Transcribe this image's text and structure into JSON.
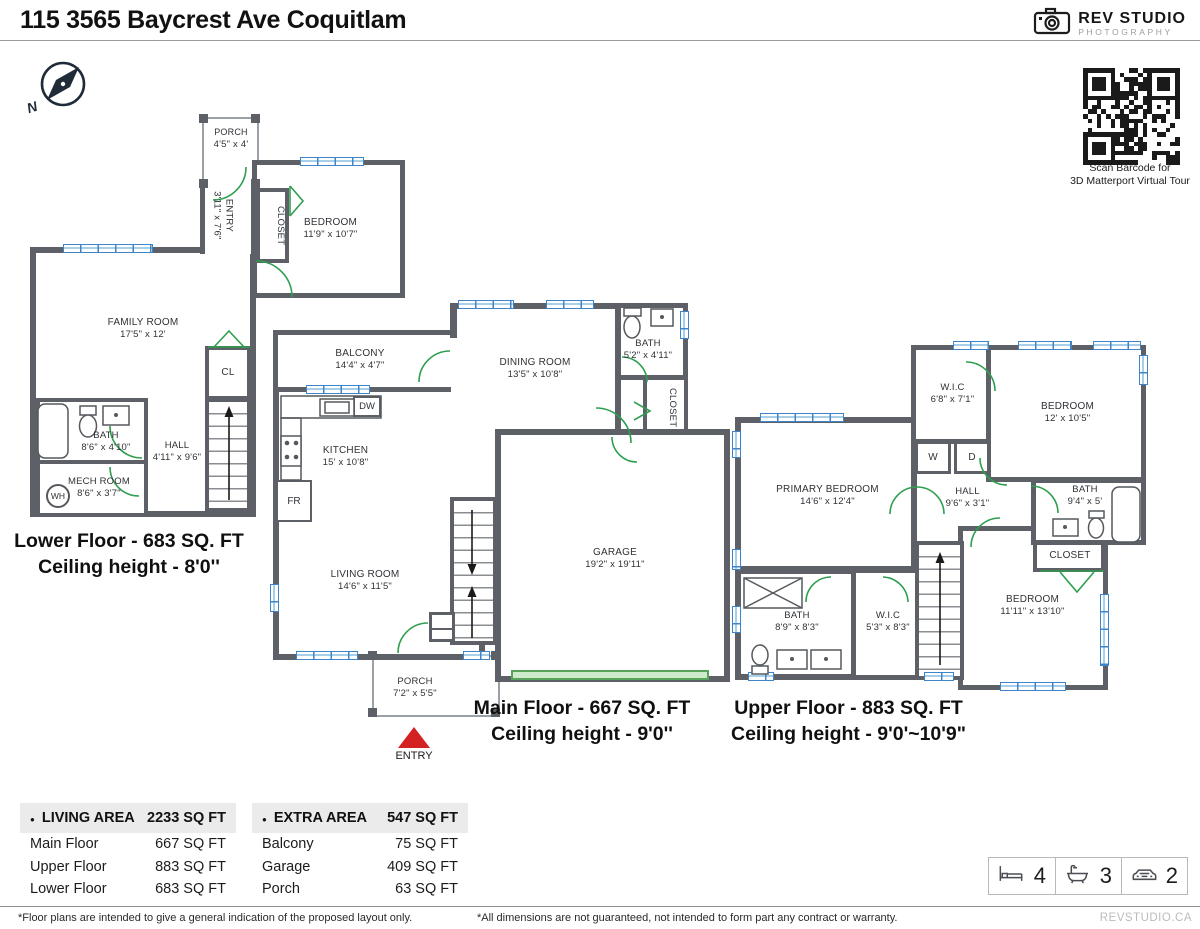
{
  "header": {
    "title": "115 3565 Baycrest Ave Coquitlam",
    "logo": {
      "name": "REV STUDIO",
      "subtitle": "PHOTOGRAPHY"
    }
  },
  "compass": {
    "north": "N"
  },
  "qr": {
    "caption1": "Scan Barcode for",
    "caption2": "3D Matterport Virtual Tour"
  },
  "floors": {
    "lower": {
      "title": "Lower Floor - 683 SQ. FT",
      "ceiling": "Ceiling height - 8'0''",
      "rooms": {
        "porch": {
          "name": "PORCH",
          "dims": "4'5\" x 4'"
        },
        "entry": {
          "name": "ENTRY",
          "dims": "3'11\" x 7'6\""
        },
        "closet": {
          "name": "CLOSET"
        },
        "bedroom": {
          "name": "BEDROOM",
          "dims": "11'9\" x 10'7\""
        },
        "family": {
          "name": "FAMILY ROOM",
          "dims": "17'5\" x 12'"
        },
        "cl": {
          "name": "CL"
        },
        "bath": {
          "name": "BATH",
          "dims": "8'6\" x 4'10\""
        },
        "hall": {
          "name": "HALL",
          "dims": "4'11\" x 9'6\""
        },
        "mech": {
          "name": "MECH ROOM",
          "dims": "8'6\" x 3'7\""
        },
        "wh": {
          "name": "WH"
        }
      }
    },
    "main": {
      "title": "Main Floor - 667 SQ. FT",
      "ceiling": "Ceiling height - 9'0''",
      "entry_label": "ENTRY",
      "rooms": {
        "balcony": {
          "name": "BALCONY",
          "dims": "14'4\" x 4'7\""
        },
        "dining": {
          "name": "DINING ROOM",
          "dims": "13'5\" x 10'8\""
        },
        "bath": {
          "name": "BATH",
          "dims": "5'2\" x 4'11\""
        },
        "closet": {
          "name": "CLOSET"
        },
        "kitchen": {
          "name": "KITCHEN",
          "dims": "15' x 10'8\""
        },
        "dw": {
          "name": "DW"
        },
        "fr": {
          "name": "FR"
        },
        "living": {
          "name": "LIVING ROOM",
          "dims": "14'6\" x 11'5\""
        },
        "garage": {
          "name": "GARAGE",
          "dims": "19'2\" x 19'11\""
        },
        "porch": {
          "name": "PORCH",
          "dims": "7'2\" x 5'5\""
        }
      }
    },
    "upper": {
      "title": "Upper Floor - 883 SQ. FT",
      "ceiling": "Ceiling height - 9'0'~10'9\"",
      "rooms": {
        "primary": {
          "name": "PRIMARY BEDROOM",
          "dims": "14'6\" x 12'4\""
        },
        "wic1": {
          "name": "W.I.C",
          "dims": "6'8\" x 7'1\""
        },
        "bedroom1": {
          "name": "BEDROOM",
          "dims": "12' x 10'5\""
        },
        "washer": {
          "name": "W"
        },
        "dryer": {
          "name": "D"
        },
        "hall": {
          "name": "HALL",
          "dims": "9'6\" x 3'1\""
        },
        "bath1": {
          "name": "BATH",
          "dims": "9'4\" x 5'"
        },
        "closet": {
          "name": "CLOSET"
        },
        "bath2": {
          "name": "BATH",
          "dims": "8'9\" x 8'3\""
        },
        "wic2": {
          "name": "W.I.C",
          "dims": "5'3\" x 8'3\""
        },
        "bedroom2": {
          "name": "BEDROOM",
          "dims": "11'11\" x 13'10\""
        }
      }
    }
  },
  "tables": {
    "bullet": "●",
    "living": {
      "header": "LIVING AREA",
      "total": "2233 SQ FT",
      "rows": [
        {
          "label": "Main Floor",
          "value": "667 SQ FT"
        },
        {
          "label": "Upper Floor",
          "value": "883 SQ FT"
        },
        {
          "label": "Lower Floor",
          "value": "683 SQ FT"
        }
      ]
    },
    "extra": {
      "header": "EXTRA AREA",
      "total": "547 SQ FT",
      "rows": [
        {
          "label": "Balcony",
          "value": "75 SQ FT"
        },
        {
          "label": "Garage",
          "value": "409 SQ FT"
        },
        {
          "label": "Porch",
          "value": "63 SQ FT"
        }
      ]
    }
  },
  "stats": {
    "beds": "4",
    "baths": "3",
    "cars": "2"
  },
  "footer": {
    "note_left": "*Floor plans are intended to give a general indication of the proposed layout only.",
    "note_right": "*All dimensions are not guaranteed, not intended to form part any contract or warranty.",
    "brand": "REVSTUDIO.CA"
  },
  "colors": {
    "wall": "#5d6066",
    "window": "#3d85c8",
    "door": "#2e9e4f",
    "entry_arrow": "#d42222",
    "garage_door": "#58a35a"
  }
}
